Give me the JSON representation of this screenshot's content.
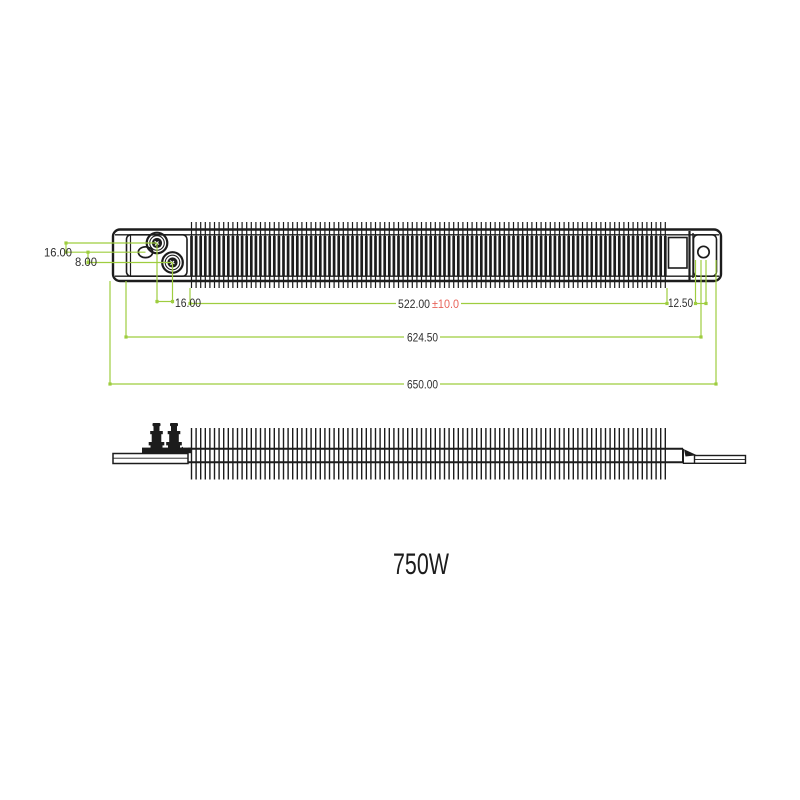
{
  "colors": {
    "drawing_line": "#1c1c1c",
    "dimension_line": "#9ecd3f",
    "tolerance_text": "#e8635a",
    "dimension_text": "#2e2e2e"
  },
  "top_view": {
    "dim_terminal1_offset": "16.00",
    "dim_hole_offset": "8.00",
    "dim_terminal_spacing": "16.00",
    "dim_finned_length": "522.00",
    "dim_finned_length_tolerance": "±10.0",
    "dim_hole_to_end": "12.50",
    "dim_hole_span": "624.50",
    "dim_overall_length": "650.00"
  },
  "footer": {
    "power_rating": "750W"
  }
}
